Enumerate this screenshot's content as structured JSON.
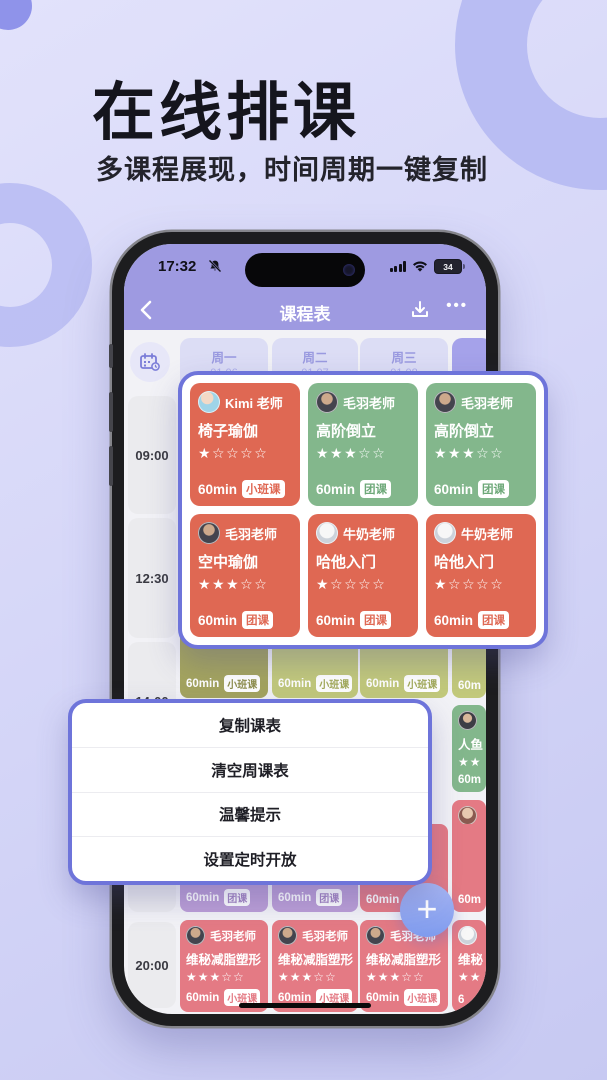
{
  "hero": {
    "title": "在线排课",
    "subtitle": "多课程展现，时间周期一键复制"
  },
  "status_bar": {
    "time": "17:32",
    "battery": "34"
  },
  "nav_bar": {
    "title": "课程表",
    "more_label": "•••"
  },
  "schedule": {
    "days": [
      {
        "weekday": "周一",
        "date": "01.06"
      },
      {
        "weekday": "周二",
        "date": "01.07"
      },
      {
        "weekday": "周三",
        "date": "01.08"
      }
    ],
    "times": {
      "t1": "09:00",
      "t2": "12:30",
      "t3": "14:00",
      "t4": "20:00"
    }
  },
  "popup": {
    "cards": [
      {
        "teacher": "Kimi 老师",
        "course": "椅子瑜伽",
        "stars": "★☆☆☆☆",
        "duration": "60min",
        "badge": "小班课",
        "color": "#df6853"
      },
      {
        "teacher": "毛羽老师",
        "course": "高阶倒立",
        "stars": "★★★☆☆",
        "duration": "60min",
        "badge": "团课",
        "color": "#83b78c"
      },
      {
        "teacher": "毛羽老师",
        "course": "高阶倒立",
        "stars": "★★★☆☆",
        "duration": "60min",
        "badge": "团课",
        "color": "#83b78c"
      },
      {
        "teacher": "毛羽老师",
        "course": "空中瑜伽",
        "stars": "★★★☆☆",
        "duration": "60min",
        "badge": "团课",
        "color": "#df6853"
      },
      {
        "teacher": "牛奶老师",
        "course": "哈他入门",
        "stars": "★☆☆☆☆",
        "duration": "60min",
        "badge": "团课",
        "color": "#df6853"
      },
      {
        "teacher": "牛奶老师",
        "course": "哈他入门",
        "stars": "★☆☆☆☆",
        "duration": "60min",
        "badge": "团课",
        "color": "#df6853"
      }
    ]
  },
  "menu": {
    "items": [
      {
        "label": "复制课表"
      },
      {
        "label": "清空周课表"
      },
      {
        "label": "温馨提示"
      },
      {
        "label": "设置定时开放"
      }
    ]
  },
  "fab": {
    "plus": "+"
  },
  "bg_cards": {
    "row3": [
      {
        "stars": "★★★☆☆",
        "duration": "60min",
        "badge": "小班课"
      },
      {
        "stars": "☆☆☆☆☆",
        "duration": "60min",
        "badge": "小班课"
      },
      {
        "stars": "☆☆☆☆☆",
        "duration": "60min",
        "badge": "小班课"
      },
      {
        "duration": "60m"
      }
    ],
    "side": [
      {
        "course": "人鱼",
        "stars": "★★",
        "duration": "60m"
      },
      {
        "course": "阴瑜",
        "stars": "★★",
        "duration": "60m"
      }
    ],
    "row4": [
      {
        "duration": "60min",
        "badge": "团课"
      },
      {
        "duration": "60min",
        "badge": "团课"
      },
      {
        "duration": "60min"
      },
      {
        "duration": "60m"
      }
    ],
    "row5": [
      {
        "teacher": "毛羽老师",
        "course": "维秘减脂塑形",
        "stars": "★★★☆☆",
        "duration": "60min",
        "badge": "小班课"
      },
      {
        "teacher": "毛羽老师",
        "course": "维秘减脂塑形",
        "stars": "★★★☆☆",
        "duration": "60min",
        "badge": "小班课"
      },
      {
        "teacher": "毛羽老师",
        "course": "维秘减脂塑形",
        "stars": "★★★☆☆",
        "duration": "60min",
        "badge": "小班课"
      },
      {
        "course": "维秘",
        "stars": "★★",
        "duration": "6"
      }
    ]
  },
  "colors": {
    "accent_border": "#6e74da",
    "header_purple": "#9e9ae1",
    "card_red": "#df6853",
    "card_green": "#83b78c",
    "card_olive": "#a4a45e",
    "card_lime": "#c2c97b",
    "card_lavender": "#bb9ed6",
    "card_pink": "#e47a84",
    "fab_blue": "#7f9bee"
  }
}
